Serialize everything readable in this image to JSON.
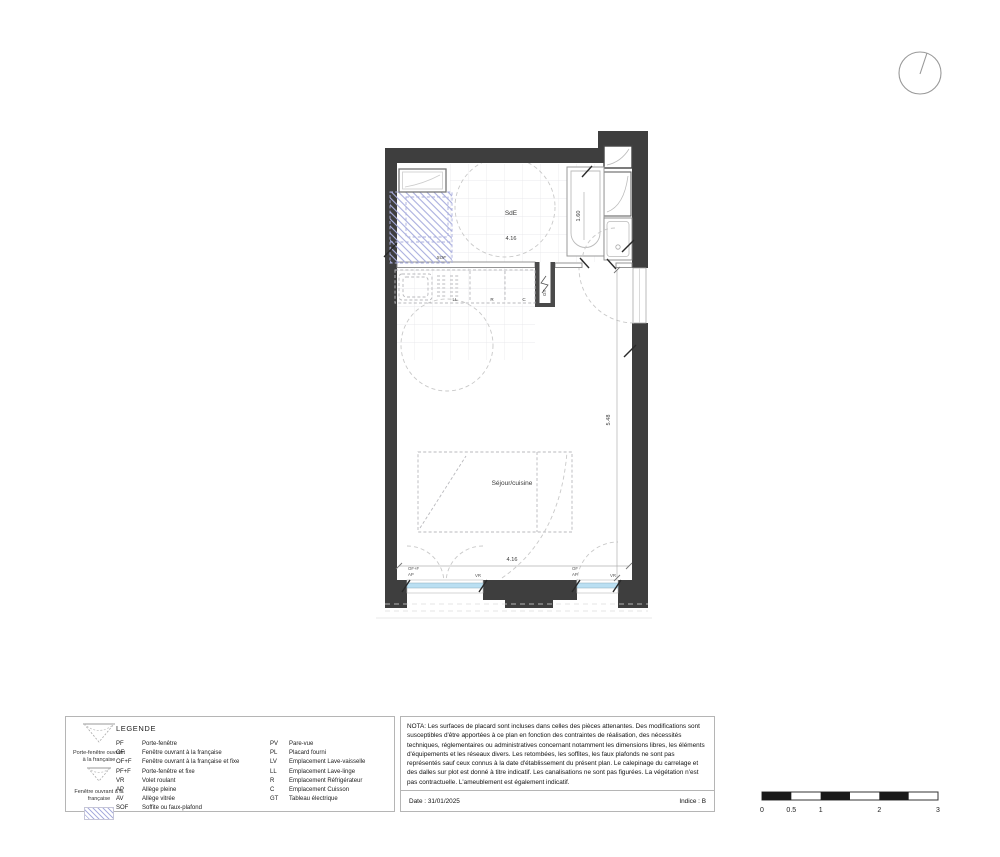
{
  "plan": {
    "rooms": {
      "sde": {
        "label": "SdE",
        "width_dim": "4.16",
        "bath_dim": "1.60"
      },
      "sejour": {
        "label": "Séjour/cuisine",
        "width_dim": "4.16",
        "height_dim": "5.48"
      }
    },
    "labels": {
      "sof": "SOF",
      "ll": "LL",
      "r": "R",
      "c": "C",
      "gt": "GT"
    },
    "windows": {
      "left": {
        "type": "OF+F",
        "sill": "AP",
        "shutter": "VR"
      },
      "right": {
        "type": "OF",
        "sill": "AP",
        "shutter": "VR"
      }
    }
  },
  "legend": {
    "title": "LEGENDE",
    "icons": [
      {
        "caption": "Porte-fenêtre ouvrant à la française"
      },
      {
        "caption": "Fenêtre ouvrant à la française"
      }
    ],
    "col1": [
      {
        "code": "PF",
        "label": "Porte-fenêtre"
      },
      {
        "code": "OF",
        "label": "Fenêtre ouvrant à la française"
      },
      {
        "code": "OF+F",
        "label": "Fenêtre ouvrant à la française et fixe"
      },
      {
        "code": "PF+F",
        "label": "Porte-fenêtre et fixe"
      },
      {
        "code": "VR",
        "label": "Volet roulant"
      },
      {
        "code": "AP",
        "label": "Allège pleine"
      },
      {
        "code": "AV",
        "label": "Allège vitrée"
      },
      {
        "code": "SOF",
        "label": "Soffite ou faux-plafond"
      }
    ],
    "col2": [
      {
        "code": "PV",
        "label": "Pare-vue"
      },
      {
        "code": "PL",
        "label": "Placard fourni"
      },
      {
        "code": "LV",
        "label": "Emplacement Lave-vaisselle"
      },
      {
        "code": "LL",
        "label": "Emplacement Lave-linge"
      },
      {
        "code": "R",
        "label": "Emplacement Réfrigérateur"
      },
      {
        "code": "C",
        "label": "Emplacement Cuisson"
      },
      {
        "code": "GT",
        "label": "Tableau électrique"
      }
    ]
  },
  "nota": {
    "text": "NOTA: Les surfaces de placard sont incluses dans celles des pièces attenantes. Des modifications sont susceptibles d'être apportées à ce plan en fonction des contraintes de réalisation, des nécessités techniques, réglementaires ou administratives concernant notamment les dimensions libres, les éléments  d'équipements et les réseaux divers. Les retombées, les soffites, les faux plafonds ne sont pas représentés sauf ceux connus à la date d'établissement du présent plan. Le calepinage du carrelage et des dalles sur plot est donné à titre indicatif. Les canalisations ne sont pas figurées. La végétation n'est pas contractuelle.  L'ameublement est également indicatif."
  },
  "footer": {
    "date": "Date : 31/01/2025",
    "indice": "Indice : B"
  },
  "scalebar": {
    "ticks": [
      "0",
      "0.5",
      "1",
      "2",
      "3"
    ]
  },
  "colors": {
    "wall": "#3e3e3e",
    "closet": "#4a4a4a",
    "glazing": "#badff2",
    "hatch": "#a9aede"
  }
}
